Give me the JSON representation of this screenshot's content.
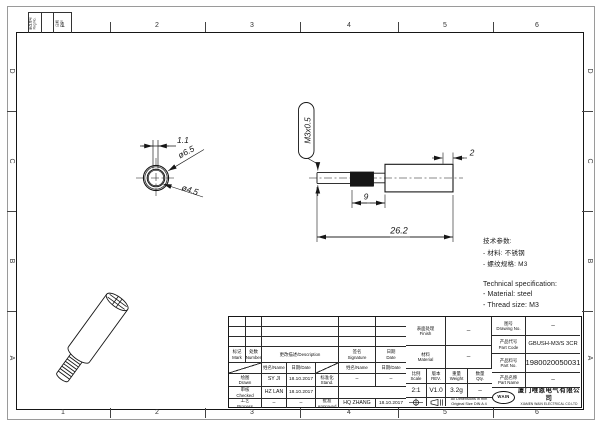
{
  "border": {
    "columns": [
      "1",
      "2",
      "3",
      "4",
      "5",
      "6"
    ],
    "rows": [
      "D",
      "C",
      "B",
      "A"
    ]
  },
  "corner_table": {
    "left": "更改单号\nReg No.",
    "right": "日期\nDate"
  },
  "top_view": {
    "dim_wall": "1.1",
    "dim_outer": "ø6.5",
    "dim_inner": "ø4.5"
  },
  "side_view": {
    "thread_label": "M3x0.5",
    "dim_step": "2",
    "dim_thread_len": "9",
    "dim_total_len": "26.2"
  },
  "tech_spec": {
    "zh_title": "技术参数:",
    "zh_items": [
      "- 材料:  不锈钢",
      "- 螺纹规格:  M3"
    ],
    "en_title": "Technical  specification:",
    "en_items": [
      "-  Material:  steel",
      "-  Thread  size:  M3"
    ]
  },
  "title_block": {
    "revision": {
      "mark": "标记\nMark",
      "number": "处数\nNumber",
      "description": "更改描述/Description",
      "signature": "签名\nSignature",
      "date": "日期\nDate",
      "name_label": "姓名/Name",
      "date_label": "日期/Date"
    },
    "signatures": {
      "drawn_label": "绘图\nDrawn",
      "drawn_name": "SY JI",
      "drawn_date": "18.10.2017",
      "checked_label": "审核\nChecked",
      "checked_name": "HZ LAN",
      "checked_date": "18.10.2017",
      "process_label": "工艺\nProcess",
      "process_name": "–",
      "process_date": "–",
      "stand_label": "标准化\nStand.",
      "stand_name": "–",
      "stand_date": "–",
      "approved_label": "批准\nApproved",
      "approved_name": "HQ ZHANG",
      "approved_date": "18.10.2017"
    },
    "info": {
      "finish_label": "表面处理\nFinish",
      "finish_value": "–",
      "material_label": "材料\nMaterial",
      "material_value": "–",
      "scale_label": "比例\nScale",
      "scale_value": "2:1",
      "rev_label": "版本\nREV.",
      "rev_value": "V1.0",
      "weight_label": "重量\nWeight",
      "weight_value": "3.2g",
      "qty_label": "数量\nQty.",
      "qty_value": "–",
      "dim_note": "All Dimensions in mm\nOriginal Size DIN A 4"
    },
    "part": {
      "drawing_no_label": "图号\nDrawing No.",
      "drawing_no_value": "–",
      "part_code_label": "产品代号\nPart Code",
      "part_code_value": "GBUSH-M3/S 3CR",
      "part_no_label": "产品料号\nPart No.",
      "part_no_value": "1980020050031",
      "part_name_label": "产品名称\nPart Name",
      "part_name_value": "–"
    },
    "company": {
      "logo": "WAIN",
      "name_zh": "厦门唯恩电气有限公司",
      "name_en": "XIAMEN WAIN ELECTRICAL CO.LTD"
    }
  }
}
